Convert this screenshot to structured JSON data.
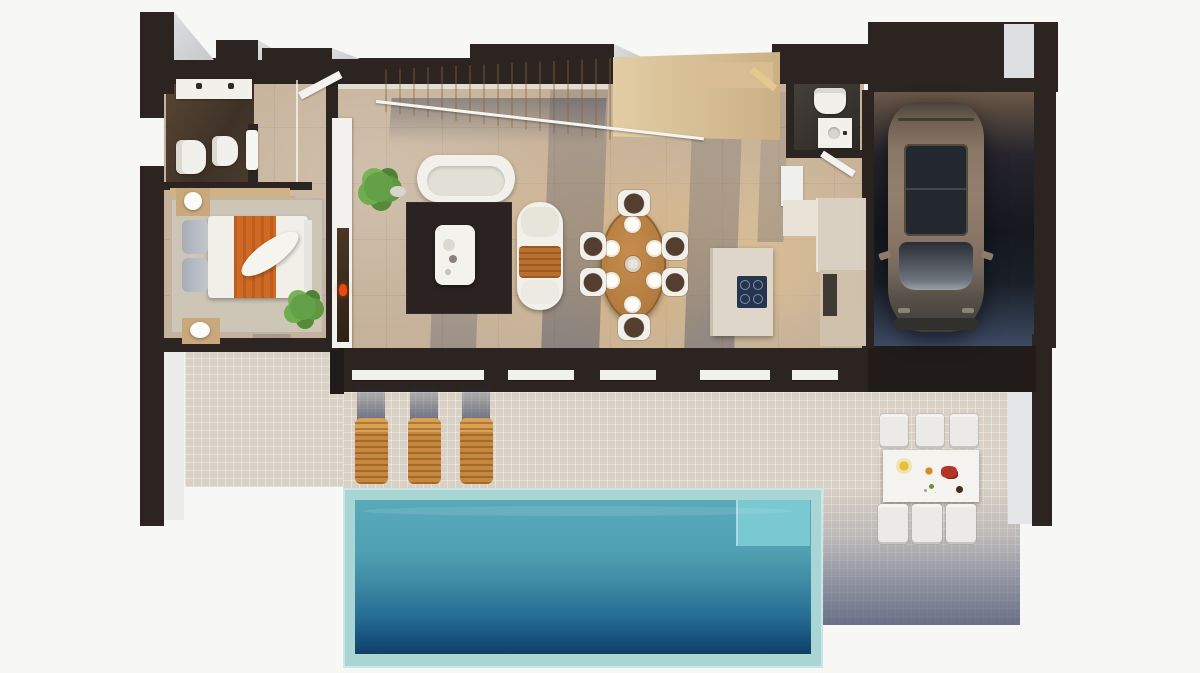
{
  "scene": {
    "type": "architectural-render",
    "view": "top-down 3D floor plan",
    "setting": "modern villa ground floor with pool terrace and garage",
    "visible_text": ""
  },
  "palette": {
    "bg": "#f7f7f5",
    "wall": "#2b2421",
    "wallDark": "#211c19",
    "floor": "#c6b29a",
    "bathFloor": "#4a3a2c",
    "wcFloor": "#37322d",
    "terrace": "#d9d1c5",
    "terraceShadow": "#66718f",
    "coping": "#a9d6d5",
    "waterTop": "#58aaba",
    "waterMid": "#3d89a4",
    "waterDeep": "#123f66",
    "steps": "#79c8d2",
    "stairs": "#e2cda4",
    "stairsDark": "#cbb084",
    "rugDark": "#2a2321",
    "rugBed": "#cdc5b6",
    "woodTable": "#b27a3e",
    "woodNight": "#c9a87b",
    "lounger": "#c8873e",
    "loungerLight": "#daa054",
    "orange": "#cf6a24",
    "red": "#e8490f",
    "green": "#639b44",
    "whiteFurn": "#f2f0ea",
    "cream": "#ded6c8",
    "hob": "#25354e",
    "carBody": "#8a7868",
    "carGlass": "#23272e"
  },
  "rooms": [
    {
      "id": "bathroom",
      "label": "en-suite bathroom",
      "furniture": [
        "white vanity with two black taps",
        "toilet",
        "bidet",
        "walk-in shower with glass screen",
        "hanging towel",
        "open door"
      ]
    },
    {
      "id": "bedroom",
      "label": "bedroom",
      "furniture": [
        "double bed with grey pillows, white duvet and orange throw",
        "wooden nightstand with white lamp",
        "wooden mat with white stool",
        "light rug",
        "potted plant"
      ]
    },
    {
      "id": "living-room",
      "label": "living room",
      "furniture": [
        "wooden staircase with glass railing",
        "curved white sofa",
        "white chaise sofa with orange throw",
        "dark brown rug",
        "white coffee table with decor",
        "potted plant",
        "white media wall with fireplace and red flame"
      ]
    },
    {
      "id": "dining-area",
      "label": "dining area",
      "furniture": [
        "oval wooden table with 6 place settings and centerpiece",
        "6 chairs with white frames and dark brown seats"
      ]
    },
    {
      "id": "kitchen",
      "label": "kitchen",
      "furniture": [
        "cream island with navy induction hob",
        "cream counter run",
        "white tall cabinet",
        "appliance niche"
      ]
    },
    {
      "id": "guest-wc",
      "label": "guest WC",
      "furniture": [
        "toilet",
        "washbasin vanity",
        "open door"
      ]
    },
    {
      "id": "garage",
      "label": "garage",
      "furniture": [
        "bronze-brown SUV with panoramic sunroof",
        "dark floor",
        "closed garage door"
      ]
    },
    {
      "id": "terrace",
      "label": "pool terrace",
      "furniture": [
        "3 wooden sun loungers with shadows",
        "rectangular pool with teal coping and corner steps",
        "white outdoor dining table with food",
        "6 white outdoor chairs"
      ]
    }
  ],
  "counts": {
    "sun_loungers": 3,
    "dining_chairs": 6,
    "outdoor_chairs": 6,
    "dining_place_settings": 6,
    "cars": 1
  },
  "pool": {
    "shape": "rectangular",
    "coping_color": "#a9d6d5",
    "water_gradient": [
      "#58aaba",
      "#3d89a4",
      "#123f66"
    ],
    "steps_color": "#79c8d2"
  }
}
